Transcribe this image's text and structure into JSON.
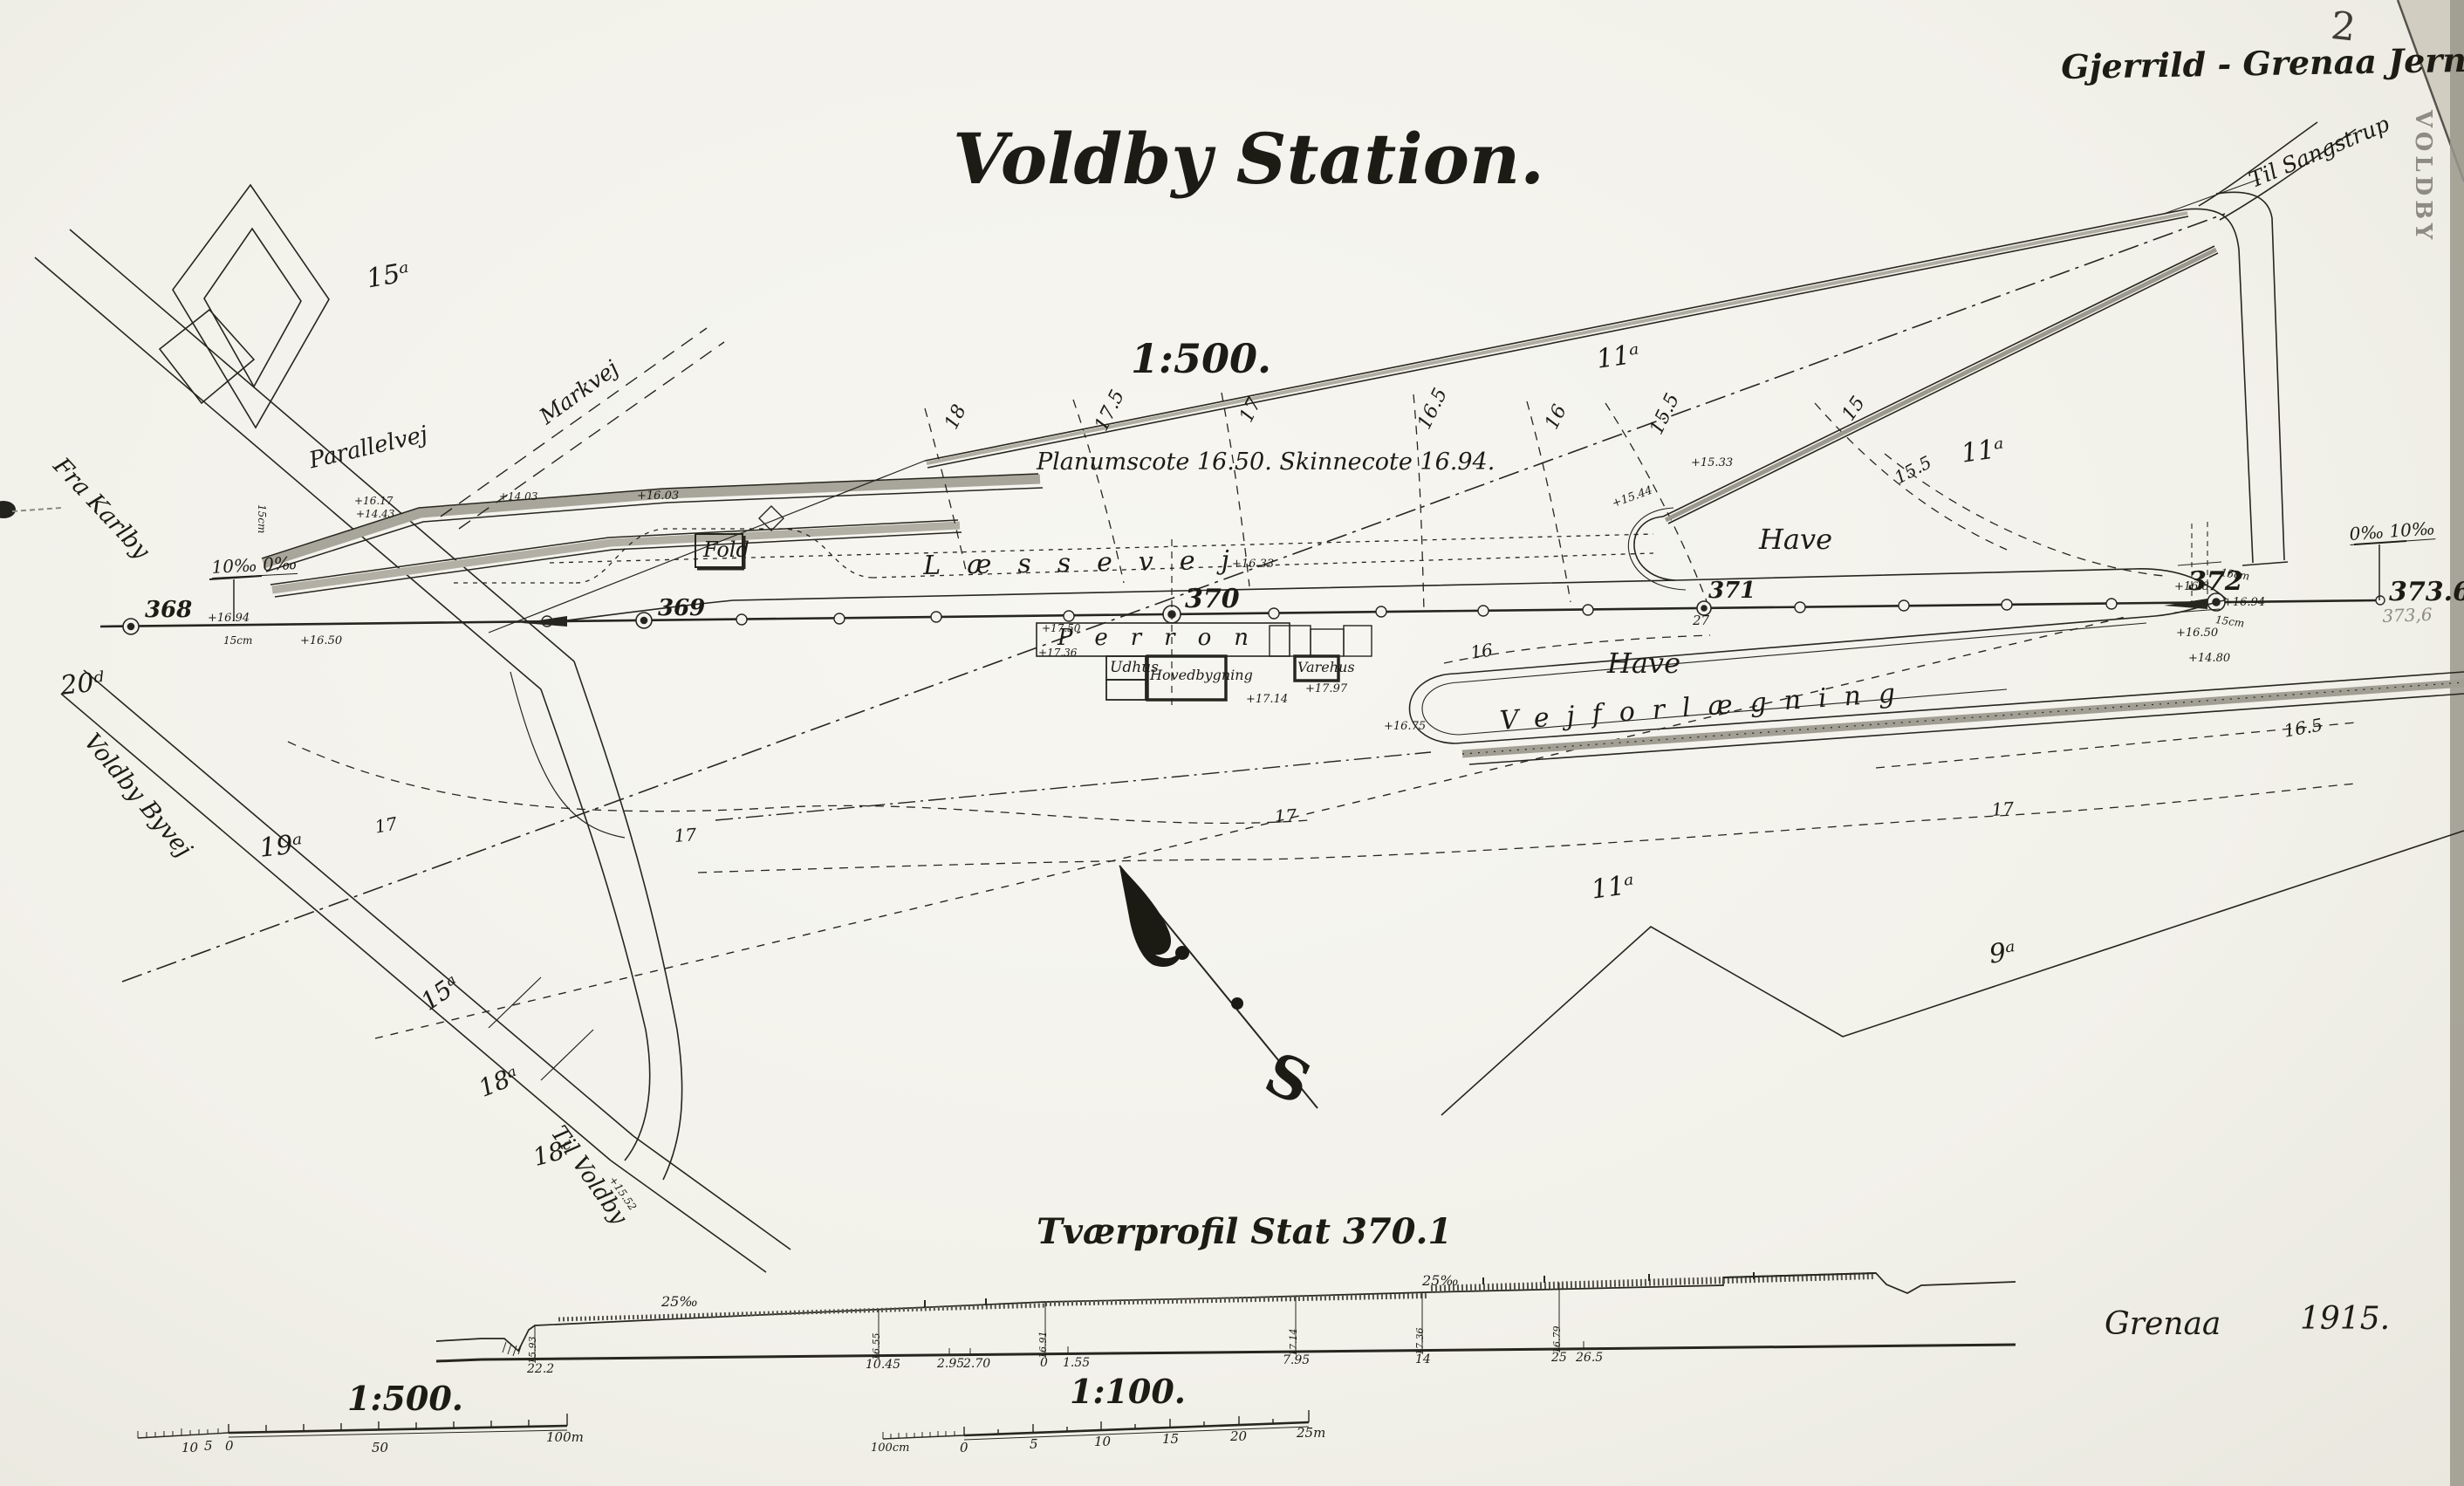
{
  "header": {
    "railway_name": "Gjerrild - Grenaa Jernbane.",
    "sheet_number": "2",
    "edge_stamp": "VOLDBY"
  },
  "title_block": {
    "title": "Voldby Station.",
    "scale": "1:500.",
    "note": "Planumscote 16.50.   Skinnecote 16.94."
  },
  "roads": {
    "fra_karlby": "Fra Karlby",
    "voldby_byvej": "Voldby Byvej",
    "til_voldby": "Til Voldby",
    "til_sangstrup": "Til Sangstrup",
    "parallelvej": "Parallelvej",
    "markvej": "Markvej",
    "laessevej": "Læssevej",
    "vejforlaegning": "Vejforlægning"
  },
  "buildings": {
    "fold": "Fold",
    "perron": "Perron",
    "udhus": "Udhus",
    "hovedbygning": "Hovedbygning",
    "varehus": "Varehus"
  },
  "areas": {
    "have_upper": "Have",
    "have_lower": "Have"
  },
  "parcels": {
    "p15a_top": "15ᵃ",
    "p11a_top": "11ᵃ",
    "p11a_right": "11ᵃ",
    "p11a_low": "11ᵃ",
    "p9a": "9ᵃ",
    "p19a": "19ᵃ",
    "p20d": "20ᵈ",
    "p15a_low": "15ᵃ",
    "p18a": "18ᵃ",
    "p18c": "18ᶜ"
  },
  "stations": {
    "s368": "368",
    "s369": "369",
    "s370": "370",
    "s371": "371",
    "s372": "372",
    "end_chainage": "373.60",
    "end_chainage_alt": "373,6",
    "under_371": "27"
  },
  "gradients": {
    "left": "10‰  0‰",
    "right": "0‰  10‰"
  },
  "contours": {
    "c18": "18",
    "c17_5": "17.5",
    "c17": "17",
    "c16_5": "16.5",
    "c16": "16",
    "c15_5": "15.5",
    "c15": "15",
    "upper15_5": "15.5",
    "loop16": "16",
    "low17a": "17",
    "low17b": "17",
    "low17c": "17",
    "low17d": "17",
    "low16_5": "16.5"
  },
  "spots": {
    "sp1": "+16.94",
    "sp2": "+16.50",
    "sp3": "+16.03",
    "sp4": "+16.33",
    "sp5": "+16.94",
    "sp6": "+16.8",
    "sp7": "+16.50",
    "sp8": "+14.80",
    "sp9": "+17.50",
    "sp10": "+17.36",
    "sp11": "+17.97",
    "sp12": "+17.14",
    "sp13": "+16.75",
    "sp14": "+15.33",
    "sp15": "+15.44",
    "sp16": "+16.17",
    "sp17": "+14.43",
    "sp18": "+14.03",
    "sp19": "+15.52"
  },
  "dims": {
    "d15cm_a": "15cm",
    "d15cm_b": "15cm",
    "d15cm_c": "15cm",
    "d15cm_d": "15cm"
  },
  "profile": {
    "title": "Tværprofil Stat 370.1",
    "grade_left": "25‰",
    "grade_right": "25‰",
    "distances": [
      "22.2",
      "10.45",
      "2.95",
      "2.70",
      "0",
      "1.55",
      "7.95",
      "14",
      "25",
      "26.5"
    ],
    "elevations": [
      "15.93",
      "16.55",
      "16.91",
      "17.14",
      "17.36",
      "16.79"
    ]
  },
  "scale_bars": {
    "s500": {
      "label": "1:500.",
      "t10": "10",
      "t5": "5",
      "t0": "0",
      "t50": "50",
      "t100": "100m"
    },
    "s100": {
      "label": "1:100.",
      "tleft": "100cm",
      "t0": "0",
      "t5": "5",
      "t10": "10",
      "t15": "15",
      "t20": "20",
      "t25": "25m"
    }
  },
  "compass": {
    "south": "S"
  },
  "footer": {
    "place": "Grenaa",
    "year": "1915."
  }
}
